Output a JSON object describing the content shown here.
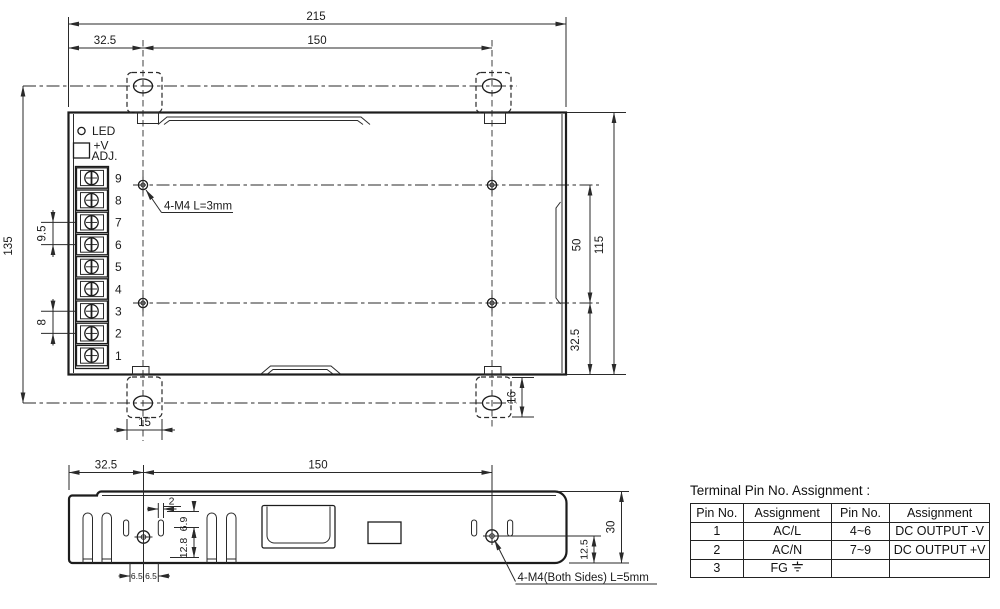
{
  "top_view": {
    "dim_width_overall": "215",
    "dim_mount_offset": "32.5",
    "dim_mount_span": "150",
    "dim_height_overall": "135",
    "dim_pitch_output": "9.5",
    "dim_pitch_input": "8",
    "dim_hole_span_v": "50",
    "dim_depth": "115",
    "dim_bottom_offset": "32.5",
    "dim_tab_height": "16",
    "dim_tab_width": "15",
    "led_label": "LED",
    "adj_label_line1": "+V",
    "adj_label_line2": "ADJ.",
    "screw_note": "4-M4 L=3mm",
    "terminals": [
      "9",
      "8",
      "7",
      "6",
      "5",
      "4",
      "3",
      "2",
      "1"
    ]
  },
  "side_view": {
    "dim_mount_offset": "32.5",
    "dim_mount_span": "150",
    "dim_slot_width": "2",
    "dim_slot_top": "6.9",
    "dim_slot_bottom": "12.8",
    "dim_left_gap": "6.5",
    "dim_right_gap": "6.5",
    "dim_hole_offset": "12.5",
    "dim_height": "30",
    "screw_note": "4-M4(Both Sides) L=5mm"
  },
  "table": {
    "title": "Terminal Pin No. Assignment :",
    "headers": [
      "Pin No.",
      "Assignment",
      "Pin No.",
      "Assignment"
    ],
    "rows": [
      [
        "1",
        "AC/L",
        "4~6",
        "DC OUTPUT -V"
      ],
      [
        "2",
        "AC/N",
        "7~9",
        "DC OUTPUT +V"
      ],
      [
        "3",
        "FG",
        "",
        ""
      ]
    ]
  },
  "colors": {
    "line": "#1c1c1c",
    "background": "#ffffff"
  }
}
